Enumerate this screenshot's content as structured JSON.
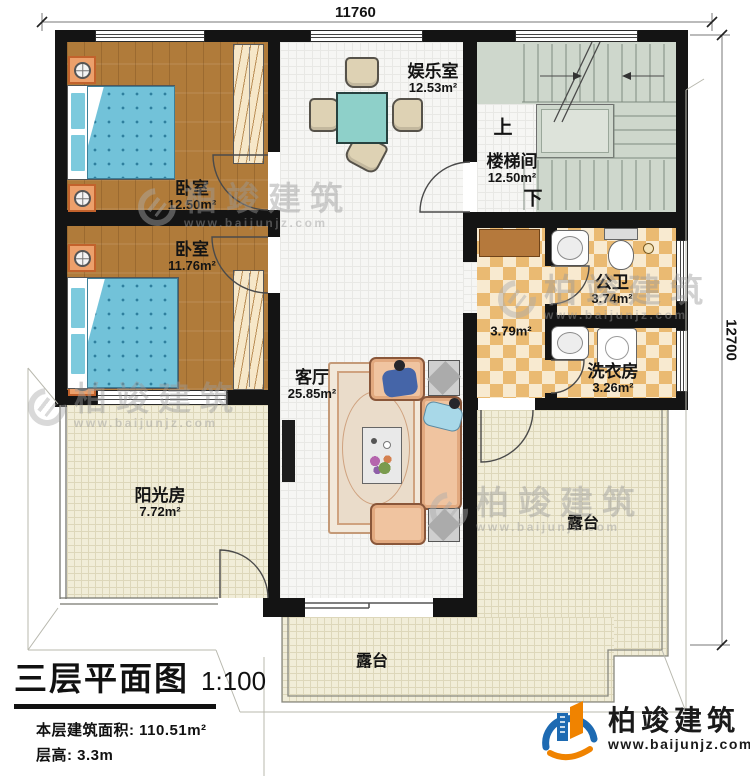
{
  "plan": {
    "dimensions": {
      "top": "11760",
      "right": "12700"
    },
    "rooms": {
      "bedroom1": {
        "name": "卧室",
        "area": "12.50m²"
      },
      "bedroom2": {
        "name": "卧室",
        "area": "11.76m²"
      },
      "entertainment": {
        "name": "娱乐室",
        "area": "12.53m²"
      },
      "stairwell": {
        "name": "楼梯间",
        "area": "12.50m²",
        "up": "上",
        "down": "下"
      },
      "bathroom": {
        "name": "公卫",
        "area": "3.74m²"
      },
      "hallway": {
        "area": "3.79m²"
      },
      "laundry": {
        "name": "洗衣房",
        "area": "3.26m²"
      },
      "living": {
        "name": "客厅",
        "area": "25.85m²"
      },
      "sunroom": {
        "name": "阳光房",
        "area": "7.72m²"
      },
      "terrace_right": {
        "name": "露台"
      },
      "terrace_bottom": {
        "name": "露台"
      }
    }
  },
  "titleblock": {
    "title": "三层平面图",
    "scale": "1:100",
    "area_label": "本层建筑面积:",
    "area_value": "110.51m²",
    "floor_height_label": "层高:",
    "floor_height_value": "3.3m"
  },
  "branding": {
    "name": "柏竣建筑",
    "url": "www.baijunjz.com",
    "blue": "#1d6ab2",
    "orange": "#f08300"
  },
  "watermark": {
    "text": "柏竣建筑",
    "url": "www.baijunjz.com"
  }
}
